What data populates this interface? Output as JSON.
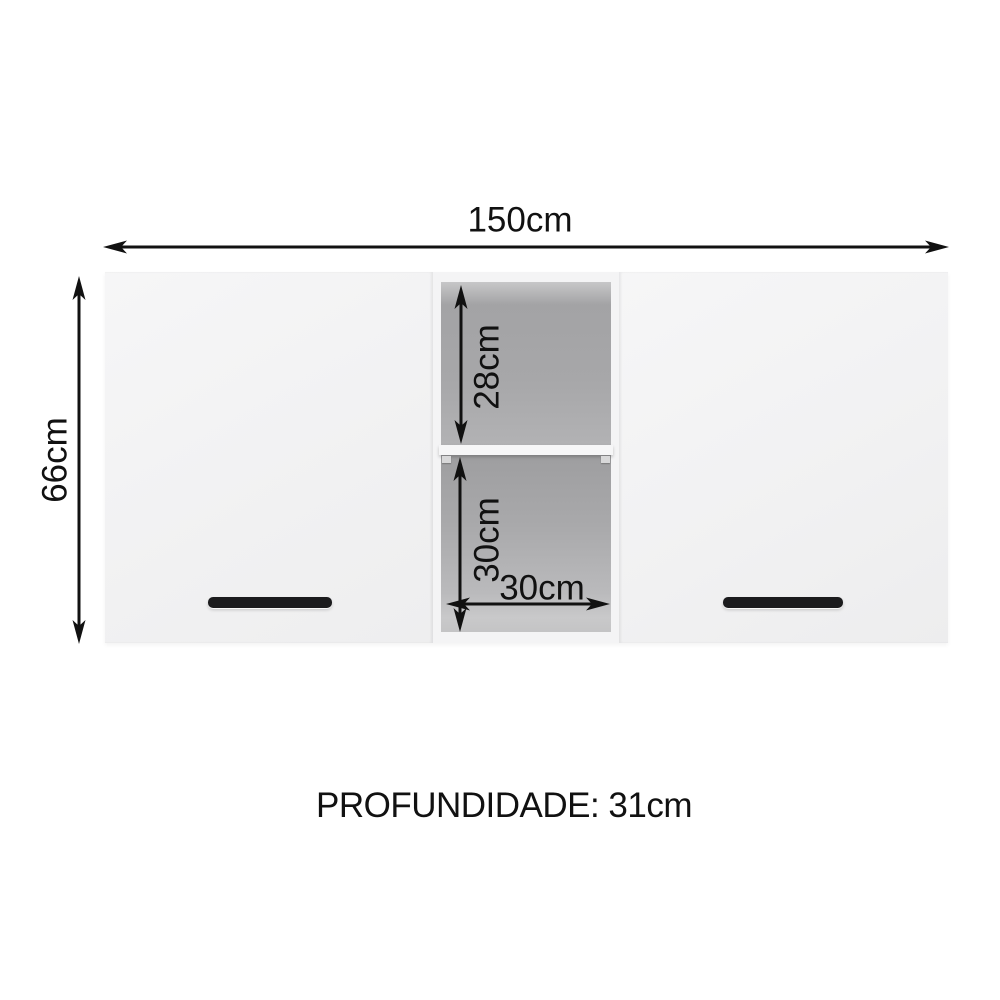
{
  "diagram": {
    "width_label": "150cm",
    "height_label": "66cm",
    "upper_niche_label": "28cm",
    "lower_niche_label": "30cm",
    "niche_width_label": "30cm",
    "depth_label": "PROFUNDIDADE: 31cm",
    "colors": {
      "dimension_line": "#111111",
      "cabinet_face": "#f2f2f3",
      "niche_interior_dark": "#a3a3a5",
      "niche_interior_light": "#c7c7c8",
      "shelf": "#f6f6f7",
      "handle": "#1b1b1d",
      "background": "#ffffff"
    }
  }
}
